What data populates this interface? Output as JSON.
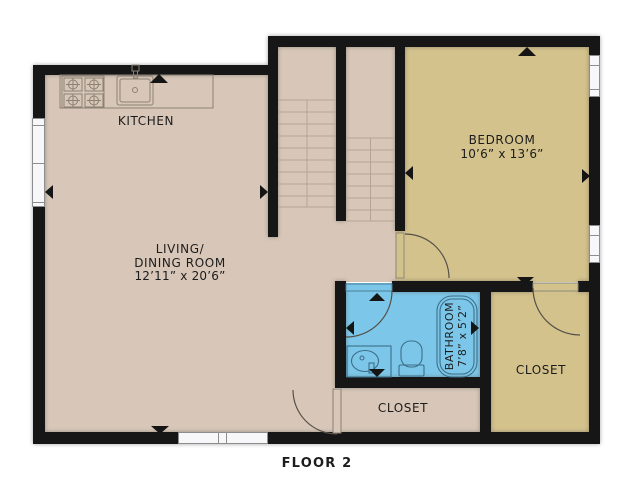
{
  "floor": {
    "caption": "FLOOR 2"
  },
  "rooms": {
    "kitchen": {
      "label": "KITCHEN"
    },
    "living_dining": {
      "line1": "LIVING/",
      "line2": "DINING ROOM",
      "dimensions": "12’11” x 20’6”"
    },
    "bedroom": {
      "label": "BEDROOM",
      "dimensions": "10’6” x 13’6”"
    },
    "bathroom": {
      "label": "BATHROOM",
      "dimensions": "7’8” x 5’2”"
    },
    "closet_center": {
      "label": "CLOSET"
    },
    "closet_right": {
      "label": "CLOSET"
    }
  },
  "fixtures": [
    "staircase",
    "stove",
    "kitchen-sink",
    "bathtub",
    "toilet",
    "bathroom-sink"
  ],
  "doors": [
    "bedroom-door",
    "bathroom-door",
    "center-closet-door",
    "right-closet-door"
  ],
  "windows": [
    "living-west-window",
    "living-south-window",
    "bedroom-east-window-upper",
    "bedroom-east-window-lower"
  ],
  "colors": {
    "floor_main": "#d8c7b8",
    "floor_bedroom_closet": "#d4c28c",
    "floor_bathroom": "#7cc7e9",
    "wall": "#161616",
    "label_text": "#1c1c1c"
  }
}
